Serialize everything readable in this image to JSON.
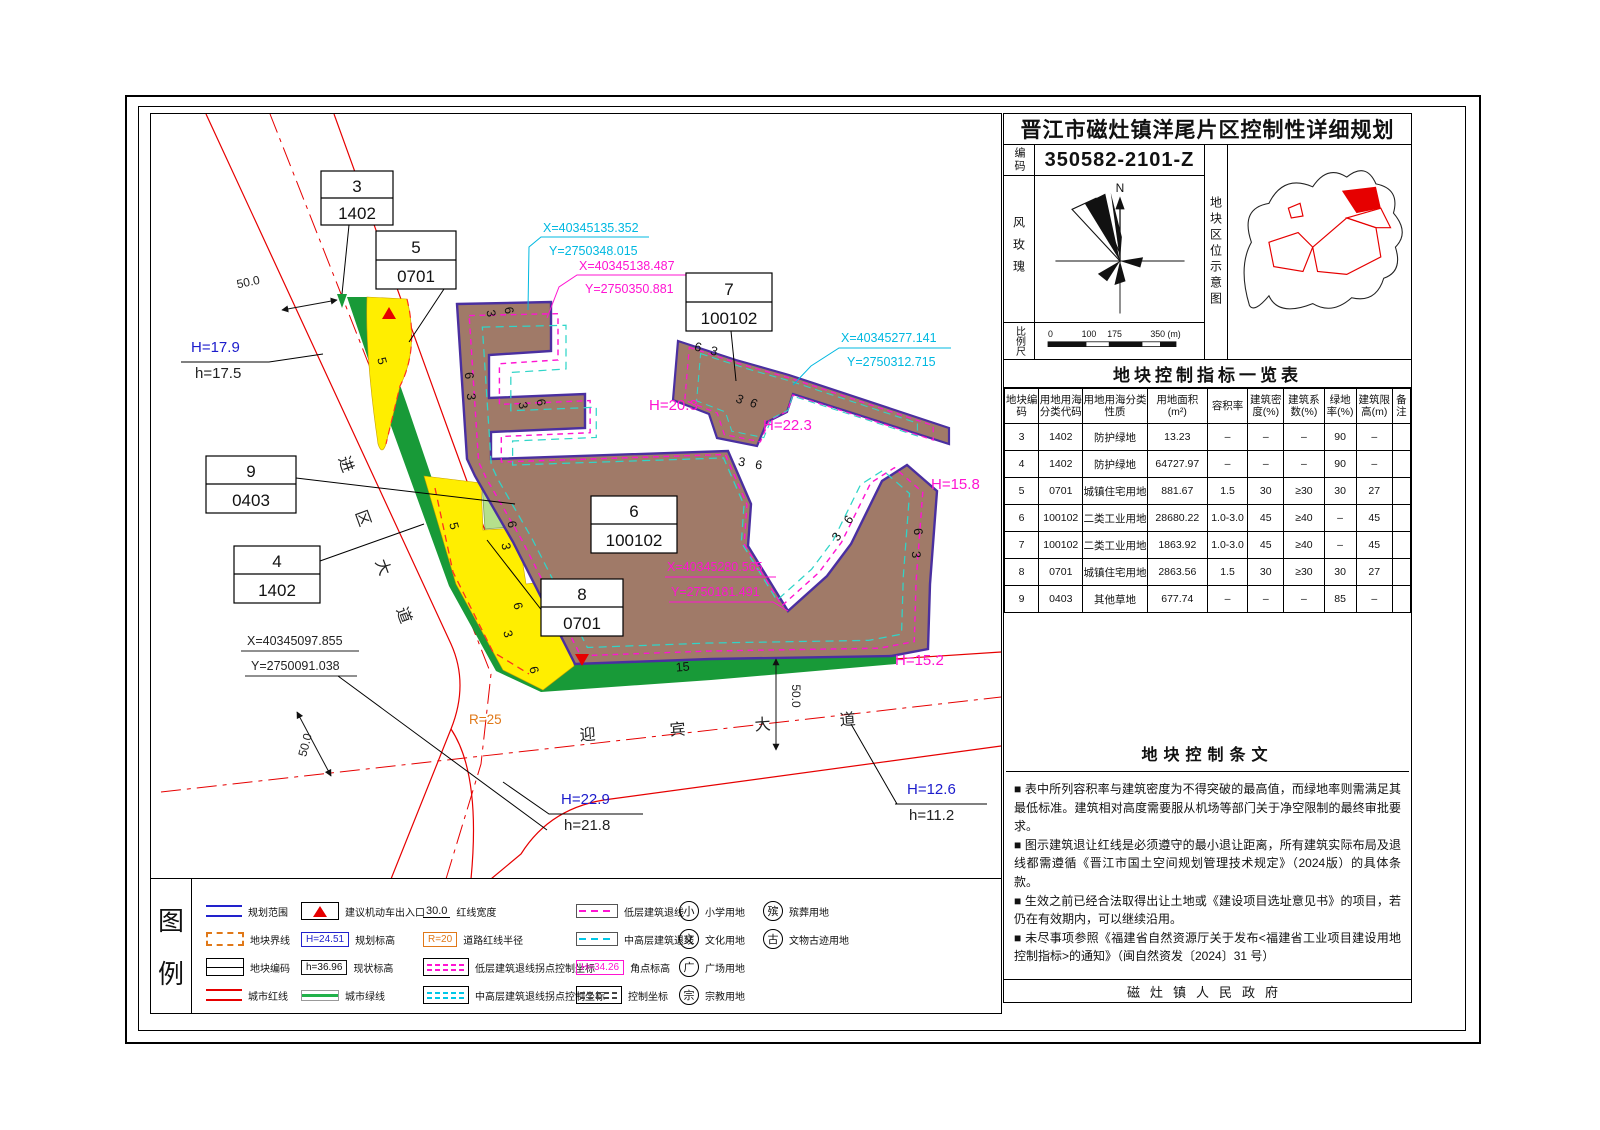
{
  "title_block": {
    "title": "晋江市磁灶镇洋尾片区控制性详细规划",
    "code_label": "编码",
    "code": "350582-2101-Z",
    "wind_rose_label": "风玫瑰",
    "north_label": "N",
    "location_label": "地块区位示意图",
    "scale_label": "比例尺",
    "scale_ticks": [
      "0",
      "100",
      "175",
      "350 (m)"
    ]
  },
  "indicator_table": {
    "title": "地块控制指标一览表",
    "headers": [
      "地块编码",
      "用地用海分类代码",
      "用地用海分类性质",
      "用地面积(m²)",
      "容积率",
      "建筑密度(%)",
      "建筑系数(%)",
      "绿地率(%)",
      "建筑限高(m)",
      "备注"
    ],
    "rows": [
      [
        "3",
        "1402",
        "防护绿地",
        "13.23",
        "–",
        "–",
        "–",
        "90",
        "–",
        ""
      ],
      [
        "4",
        "1402",
        "防护绿地",
        "64727.97",
        "–",
        "–",
        "–",
        "90",
        "–",
        ""
      ],
      [
        "5",
        "0701",
        "城镇住宅用地",
        "881.67",
        "1.5",
        "30",
        "≥30",
        "30",
        "27",
        ""
      ],
      [
        "6",
        "100102",
        "二类工业用地",
        "28680.22",
        "1.0-3.0",
        "45",
        "≥40",
        "–",
        "45",
        ""
      ],
      [
        "7",
        "100102",
        "二类工业用地",
        "1863.92",
        "1.0-3.0",
        "45",
        "≥40",
        "–",
        "45",
        ""
      ],
      [
        "8",
        "0701",
        "城镇住宅用地",
        "2863.56",
        "1.5",
        "30",
        "≥30",
        "30",
        "27",
        ""
      ],
      [
        "9",
        "0403",
        "其他草地",
        "677.74",
        "–",
        "–",
        "–",
        "85",
        "–",
        ""
      ]
    ]
  },
  "provisions": {
    "title": "地块控制条文",
    "items": [
      "■ 表中所列容积率与建筑密度为不得突破的最高值，而绿地率则需满足其最低标准。建筑相对高度需要服从机场等部门关于净空限制的最终审批要求。",
      "■ 图示建筑退让红线是必须遵守的最小退让距离，所有建筑实际布局及退线都需遵循《晋江市国土空间规划管理技术规定》（2024版）的具体条款。",
      "■ 生效之前已经合法取得出让土地或《建设项目选址意见书》的项目，若仍在有效期内，可以继续沿用。",
      "■ 未尽事项参照《福建省自然资源厅关于发布<福建省工业项目建设用地控制指标>的通知》（闽自然资发〔2024〕31 号）"
    ]
  },
  "footer": "磁灶镇人民政府",
  "legend": {
    "panel_chars": [
      "图",
      "例"
    ],
    "plan_boundary": "规划范围",
    "parcel_boundary": "地块界线",
    "parcel_code": "地块编码",
    "city_redline": "城市红线",
    "entrance": "建议机动车出入口",
    "planned_elev_value": "H=24.51",
    "planned_elev": "规划标高",
    "existing_elev_value": "h=36.96",
    "existing_elev": "现状标高",
    "city_greenline": "城市绿线",
    "redline_width_value": "30.0",
    "redline_width": "红线宽度",
    "road_radius_value": "R=20",
    "road_radius": "道路红线半径",
    "low_setback_coord": "低层建筑退线拐点控制坐标",
    "mid_setback_coord": "中高层建筑退线拐点控制坐标",
    "low_setback_line": "低层建筑退线",
    "mid_setback_line": "中高层建筑退线",
    "corner_elev_value": "H=34.26",
    "corner_elev": "角点标高",
    "control_coord": "控制坐标",
    "primary_school_char": "小",
    "primary_school": "小学用地",
    "culture_char": "文",
    "culture": "文化用地",
    "square_char": "广",
    "square": "广场用地",
    "religion_char": "宗",
    "religion": "宗教用地",
    "funeral_char": "殡",
    "funeral": "殡葬用地",
    "heritage_char": "古",
    "heritage": "文物古迹用地"
  },
  "map": {
    "parcels": [
      {
        "num": "3",
        "code": "1402"
      },
      {
        "num": "5",
        "code": "0701"
      },
      {
        "num": "7",
        "code": "100102"
      },
      {
        "num": "9",
        "code": "0403"
      },
      {
        "num": "4",
        "code": "1402"
      },
      {
        "num": "6",
        "code": "100102"
      },
      {
        "num": "8",
        "code": "0701"
      }
    ],
    "coords": [
      {
        "x": "X=40345135.352",
        "y": "Y=2750348.015"
      },
      {
        "x": "X=40345138.487",
        "y": "Y=2750350.881"
      },
      {
        "x": "X=40345277.141",
        "y": "Y=2750312.715"
      },
      {
        "x": "X=40345280.565",
        "y": "Y=2750181.491"
      },
      {
        "x": "X=40345097.855",
        "y": "Y=2750091.038"
      }
    ],
    "elevations": [
      {
        "planned": "H=17.9",
        "existing": "h=17.5"
      },
      {
        "planned": "H=22.9",
        "existing": "h=21.8"
      },
      {
        "planned": "H=12.6",
        "existing": "h=11.2"
      }
    ],
    "spot_heights": [
      "H=20.3",
      "H=22.3",
      "H=15.8",
      "H=15.2"
    ],
    "road_jinqu": [
      "进",
      "区",
      "大",
      "道"
    ],
    "road_yingbin": [
      "迎",
      "宾",
      "大",
      "道"
    ],
    "dims": {
      "d1": "50.0",
      "d2": "50.0",
      "d3": "50.0"
    },
    "radius_label": "R=25",
    "setback_labels": [
      {
        "t": "3",
        "x": 336,
        "y": 200,
        "r": 80
      },
      {
        "t": "6",
        "x": 354,
        "y": 197,
        "r": 80
      },
      {
        "t": "6",
        "x": 314,
        "y": 262,
        "r": 85
      },
      {
        "t": "3",
        "x": 316,
        "y": 283,
        "r": 85
      },
      {
        "t": "3",
        "x": 368,
        "y": 292,
        "r": 80
      },
      {
        "t": "6",
        "x": 386,
        "y": 289,
        "r": 80
      },
      {
        "t": "3",
        "x": 590,
        "y": 352,
        "r": 10
      },
      {
        "t": "6",
        "x": 607,
        "y": 355,
        "r": 10
      },
      {
        "t": "6",
        "x": 701,
        "y": 408,
        "r": -55
      },
      {
        "t": "3",
        "x": 689,
        "y": 425,
        "r": -55
      },
      {
        "t": "6",
        "x": 763,
        "y": 418,
        "r": 85
      },
      {
        "t": "3",
        "x": 761,
        "y": 441,
        "r": 85
      },
      {
        "t": "6",
        "x": 546,
        "y": 237,
        "r": 15
      },
      {
        "t": "3",
        "x": 562,
        "y": 241,
        "r": 15
      },
      {
        "t": "6",
        "x": 601,
        "y": 293,
        "r": 25
      },
      {
        "t": "3",
        "x": 587,
        "y": 289,
        "r": 25
      },
      {
        "t": "5",
        "x": 227,
        "y": 248,
        "r": 75
      },
      {
        "t": "5",
        "x": 299,
        "y": 413,
        "r": 75
      },
      {
        "t": "6",
        "x": 357,
        "y": 411,
        "r": 80
      },
      {
        "t": "3",
        "x": 351,
        "y": 433,
        "r": 80
      },
      {
        "t": "6",
        "x": 363,
        "y": 493,
        "r": 75
      },
      {
        "t": "3",
        "x": 353,
        "y": 521,
        "r": 75
      },
      {
        "t": "6",
        "x": 379,
        "y": 557,
        "r": 75
      },
      {
        "t": "15",
        "x": 532,
        "y": 557,
        "r": -5
      }
    ]
  }
}
